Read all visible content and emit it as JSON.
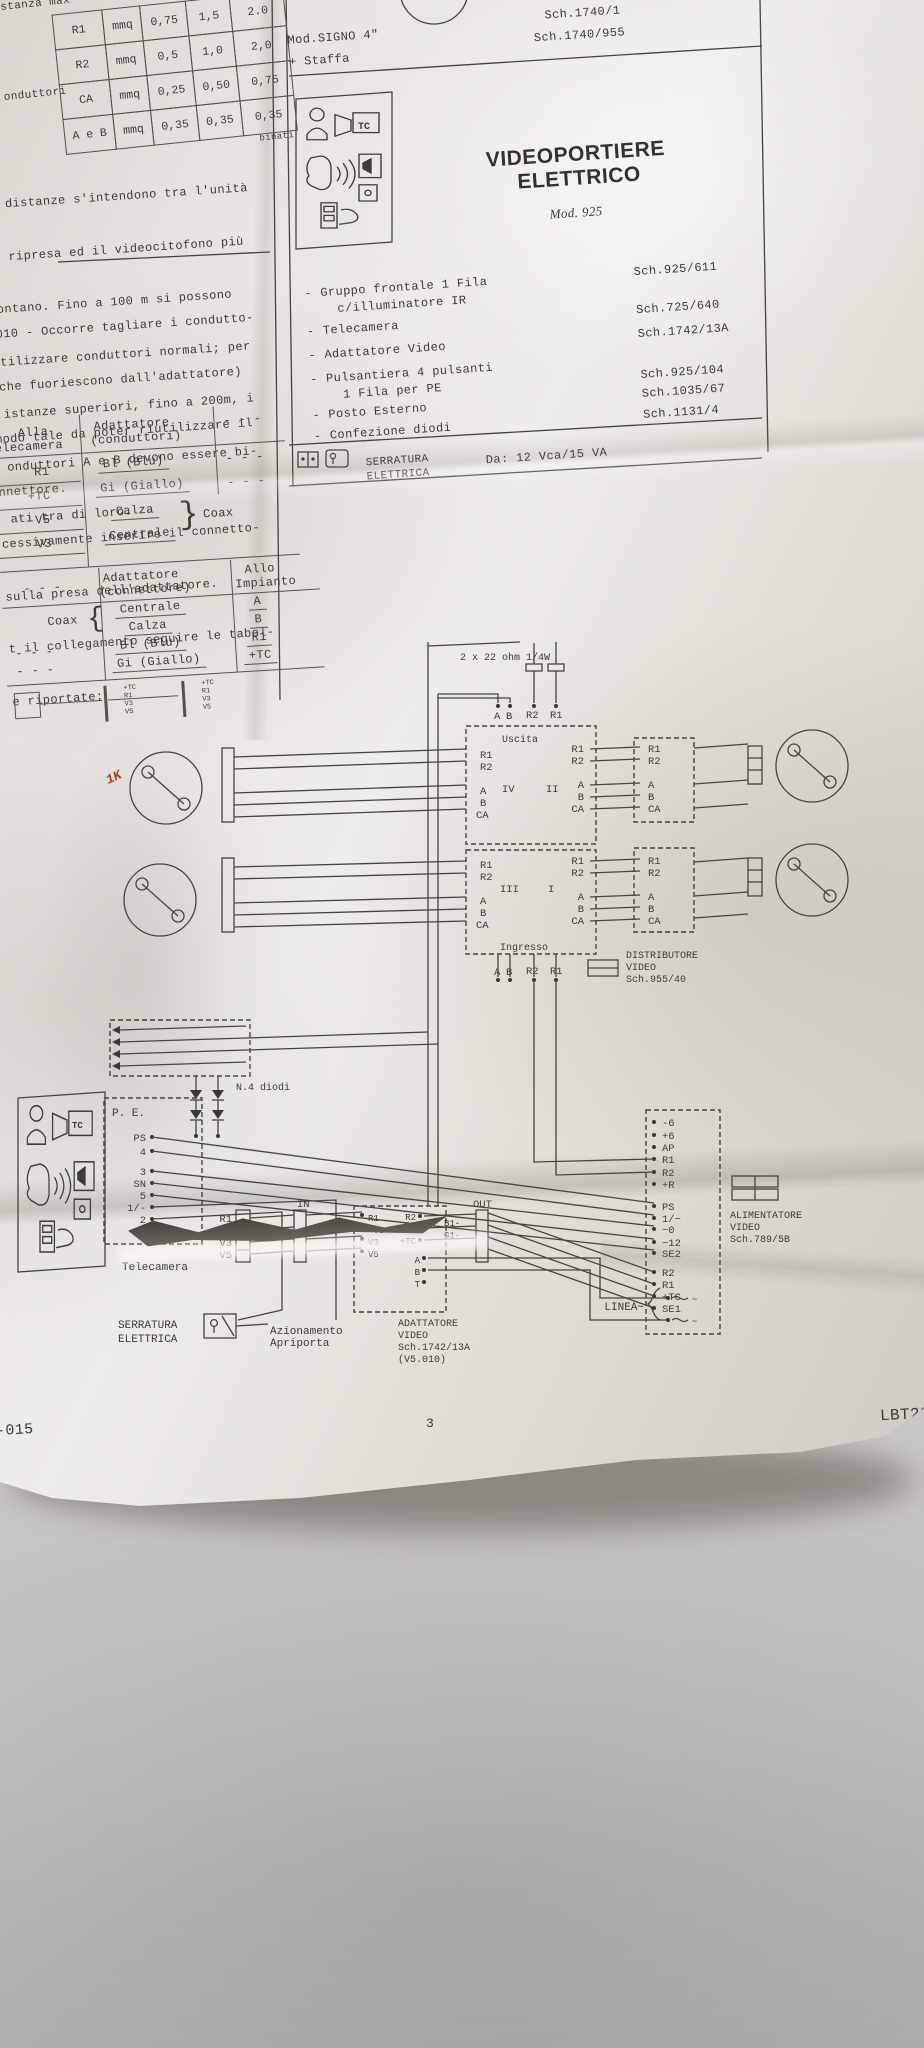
{
  "photo": {
    "background": "#c6c4c0",
    "paper": "#eae7e1",
    "ink": "#3d3b35",
    "red_mark": "#a93b2e"
  },
  "icons": {
    "tc": "TC"
  },
  "wire_table": {
    "corner": "stanza max",
    "side": "onduttori",
    "note": "binati",
    "rows": [
      [
        "R1",
        "mmq",
        "0,75",
        "1,5",
        "2.0"
      ],
      [
        "R2",
        "mmq",
        "0,5",
        "1,0",
        "2,0"
      ],
      [
        "CA",
        "mmq",
        "0,25",
        "0,50",
        "0,75"
      ],
      [
        "A e B",
        "mmq",
        "0,35",
        "0,35",
        "0,35"
      ]
    ]
  },
  "notes": {
    "para1": [
      "e distanze s'intendono tra l'unità",
      "i ripresa ed il videocitofono più",
      "ontano. Fino a 100 m si possono",
      "tilizzare conduttori normali; per",
      "istanze superiori, fino a 200m, i",
      "onduttori A e B devono essere bi-",
      "ati tra di loro."
    ],
    "para2": [
      ".010 - Occorre tagliare i condutto-",
      "(che fuoriescono dall'adattatore)",
      "modo tale da poter riutilizzare il",
      "nnettore.",
      "cessivamente inserire il connetto-",
      "sulla presa dell'adattatore.",
      "t il collegamento seguire le tabel-",
      "e riportate:"
    ]
  },
  "table_a": {
    "h1a": "Alla",
    "h1b": "elecamera",
    "h2a": "Adattatore",
    "h2b": "(conduttori)",
    "dash": "- - -",
    "brace": "}",
    "coax": "Coax",
    "r1a": "R1",
    "r1b": "Bl (Blu)",
    "r2a": "+TC",
    "r2b": "Gi (Giallo)",
    "r3a": "V5",
    "r3b": "Calza",
    "r4a": "V3",
    "r4b": "Centrale"
  },
  "table_b": {
    "h0": "- - -",
    "h1a": "Adattatore",
    "h1b": "(connettore)",
    "h2a": "Allo",
    "h2b": "Impianto",
    "coax": "Coax",
    "brace": "{",
    "r1b": "Centrale",
    "r1c": "A",
    "r2b": "Calza",
    "r2c": "B",
    "r3a": "- - -",
    "r3b": "Bl (Blu)",
    "r3c": "R1",
    "r4a": "- - -",
    "r4b": "Gi (Giallo)",
    "r4c": "+TC"
  },
  "mini_pins": [
    "+TC",
    "R1",
    "V3",
    "V5"
  ],
  "header": {
    "model1": "Mod.SIGNO 4\"",
    "model2": "+ Staffa",
    "sch1": "Sch.1740/1",
    "sch2": "Sch.1740/955"
  },
  "kit": {
    "bullet": "-",
    "title1": "VIDEOPORTIERE",
    "title2": "ELETTRICO",
    "model": "Mod. 925",
    "items": [
      {
        "l1": "Gruppo frontale 1 Fila",
        "l2": "c/illuminatore IR",
        "sch": "Sch.925/611"
      },
      {
        "l1": "Telecamera",
        "sch": "Sch.725/640"
      },
      {
        "l1": "Adattatore Video",
        "sch": "Sch.1742/13A"
      },
      {
        "l1": "Pulsantiera 4 pulsanti",
        "l2": "1 Fila per PE",
        "sch": "Sch.925/104"
      },
      {
        "l1": "Posto Esterno",
        "sch": "Sch.1035/67"
      },
      {
        "l1": "Confezione diodi",
        "sch": "Sch.1131/4"
      }
    ],
    "lock1": "SERRATURA",
    "lock2": "ELETTRICA",
    "lock_rating": "Da: 12 Vca/15 VA"
  },
  "sch": {
    "res": "2 x 22 ohm 1/4W",
    "uscita": "Uscita",
    "ingresso": "Ingresso",
    "bus": [
      "A",
      "B",
      "R2",
      "R1"
    ],
    "units": [
      "IV",
      "II",
      "III",
      "I"
    ],
    "pins": [
      "R1",
      "R2",
      "A",
      "B",
      "CA"
    ],
    "dist": [
      "DISTRIBUTORE",
      "VIDEO",
      "Sch.955/40"
    ],
    "diodes": "N.4 diodi",
    "pe": "P. E.",
    "pe_pins": [
      "PS",
      "4",
      "3",
      "SN",
      "5",
      "1/-",
      "2"
    ],
    "camera": "Telecamera",
    "cam_pins": [
      "R1",
      "+TC",
      "V3",
      "V5"
    ],
    "lock1": "SERRATURA",
    "lock2": "ELETTRICA",
    "release1": "Azionamento",
    "release2": "Apriporta",
    "adapter": [
      "ADATTATORE",
      "VIDEO",
      "Sch.1742/13A",
      "(V5.010)"
    ],
    "in_label": "IN",
    "out_label": "OUT",
    "ad_right": [
      "R2",
      "R1",
      "+TC"
    ],
    "ad_wires": [
      "B1-",
      "G1-"
    ],
    "ad_bottom": [
      "A",
      "B",
      "T"
    ],
    "psu": [
      "ALIMENTATORE",
      "VIDEO",
      "Sch.789/5B"
    ],
    "psu_a": [
      "-6",
      "+6",
      "AP",
      "R1",
      "R2",
      "+R"
    ],
    "psu_b": [
      "PS",
      "1/~",
      "~0",
      "~12",
      "SE2"
    ],
    "psu_c": [
      "R2",
      "R1",
      "+TC",
      "SE1"
    ],
    "linea": "LINEA~",
    "linea_pins": [
      "~",
      "~"
    ],
    "mark": "1K"
  },
  "footer": {
    "left": "-015",
    "page": "3",
    "right": "LBT29"
  }
}
